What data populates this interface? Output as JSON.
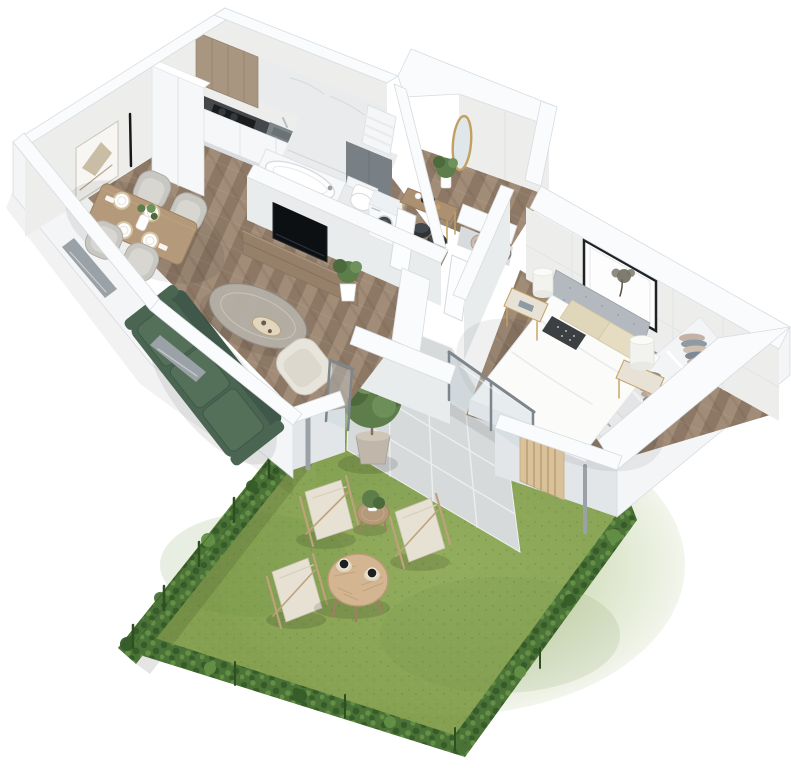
{
  "meta": {
    "description": "3D isometric dollhouse floor-plan rendering of a one-bedroom apartment with a private fenced garden, paved terrace and outdoor furniture",
    "view": "isometric top-down cutaway",
    "background": "#ffffff"
  },
  "palette": {
    "wall-top": "#fafbfc",
    "wall-edge": "#d7dce0",
    "wall-face": "#edeeec",
    "wall-face-cool": "#e9eced",
    "wall-shade": "#e2e6e9",
    "wall-bright": "#f3f5f7",
    "marble": "#e9ebec",
    "marble-vein": "#d2d6d8",
    "wood-floor": "#9a8571",
    "wood-floor-dark": "#8d7865",
    "wood-floor-light": "#a7927e",
    "tile": "#d6dadb",
    "tile-grout": "#eff1f1",
    "grass": "#84a050",
    "grass-light": "#97b163",
    "grass-dark": "#6d8a42",
    "hedge": "#4b7237",
    "hedge-dark": "#365c29",
    "hedge-light": "#639045",
    "fence": "#2d4f22",
    "wood-cabinet": "#a99681",
    "wood-table": "#b4997b",
    "wood-table-dark": "#9b8161",
    "wood-console": "#97806a",
    "counter": "#45484b",
    "cooktop": "#1a1c1e",
    "steel": "#7d8589",
    "steel-dark": "#6a7276",
    "tv": "#0d1013",
    "sofa": "#4a6551",
    "sofa-dark": "#3f584a",
    "sofa-light": "#547059",
    "chair": "#c9c7c2",
    "chair-light": "#d8d6d1",
    "cream": "#e7e4db",
    "gold": "#c2a060",
    "glass": "#c9d6d9",
    "frame-gray": "#7f868b",
    "bed-head": "#b3b9bf",
    "duvet": "#fbfbfa",
    "pillow-beige": "#e0d6ba",
    "pillow-dark": "#3c4043",
    "slat": "#d9c29a",
    "pot": "#c0b6a9",
    "plant": "#5d7d4b",
    "plant-dark": "#4c6a3c",
    "plant-light": "#6f915c",
    "cup": "#1e2022",
    "saucer": "#e2d7be",
    "canvas": "#e6e1d2",
    "deck-frame": "#bda27c",
    "towel-pink": "#cdb9af",
    "towel-mauve": "#bfa99e",
    "towel-brown": "#998a83",
    "cloth-blue": "#8e9aa4",
    "cloth-slate": "#7d8a95",
    "cloth-pink": "#c4b2a6",
    "cloth-cream": "#cfbfb1",
    "radiator": "#f4f6f7",
    "furn-white": "#f5f7f8",
    "furn-edge": "#dfe3e6",
    "panel-gray": "#788086"
  },
  "scene": {
    "living_dining_kitchen": {
      "floor": "chevron wood parquet",
      "items": [
        "wood upper cabinets",
        "tall white cabinet",
        "dark countertop",
        "induction cooktop",
        "kitchen sink with faucet",
        "white base cabinets",
        "marble backsplash",
        "dining table",
        "four gray dining chairs",
        "four place settings",
        "vase with greenery",
        "abstract wall art",
        "two black strip wall lights",
        "green three-seat sofa",
        "oval coffee table with tray",
        "cream armchair",
        "wall-mounted tv",
        "wooden tv console",
        "potted plant"
      ]
    },
    "bathroom": {
      "floor": "marble tile",
      "items": [
        "bathtub",
        "wall-hung toilet",
        "gray feature panel",
        "towel radiator",
        "washing machine",
        "marble walls"
      ]
    },
    "hallway": {
      "floor": "chevron wood parquet",
      "items": [
        "gold oval mirror",
        "console table with gold legs",
        "black decor tray",
        "two dark poufs",
        "potted plant",
        "two white doors with gold handles",
        "linen niche with rolled towels"
      ]
    },
    "bedroom": {
      "floor": "chevron wood parquet",
      "items": [
        "double bed with gray upholstered headboard",
        "white duvet",
        "beige pillows",
        "dark patterned cushion",
        "framed tree artwork",
        "panelled accent wall",
        "two nightstands with gold legs",
        "two white cylinder lamps",
        "stack of blue books",
        "open wardrobe with folded clothes",
        "drawer unit",
        "sliding glass door",
        "wooden slat screen"
      ]
    },
    "garden": {
      "ground": "lawn",
      "items": [
        "paved terrace with grout lines",
        "hedge boundary with green fence posts",
        "potted tree",
        "three canvas deck chairs",
        "round wooden table",
        "two coffee cups",
        "side table with plant",
        "downspout pipes"
      ]
    }
  }
}
